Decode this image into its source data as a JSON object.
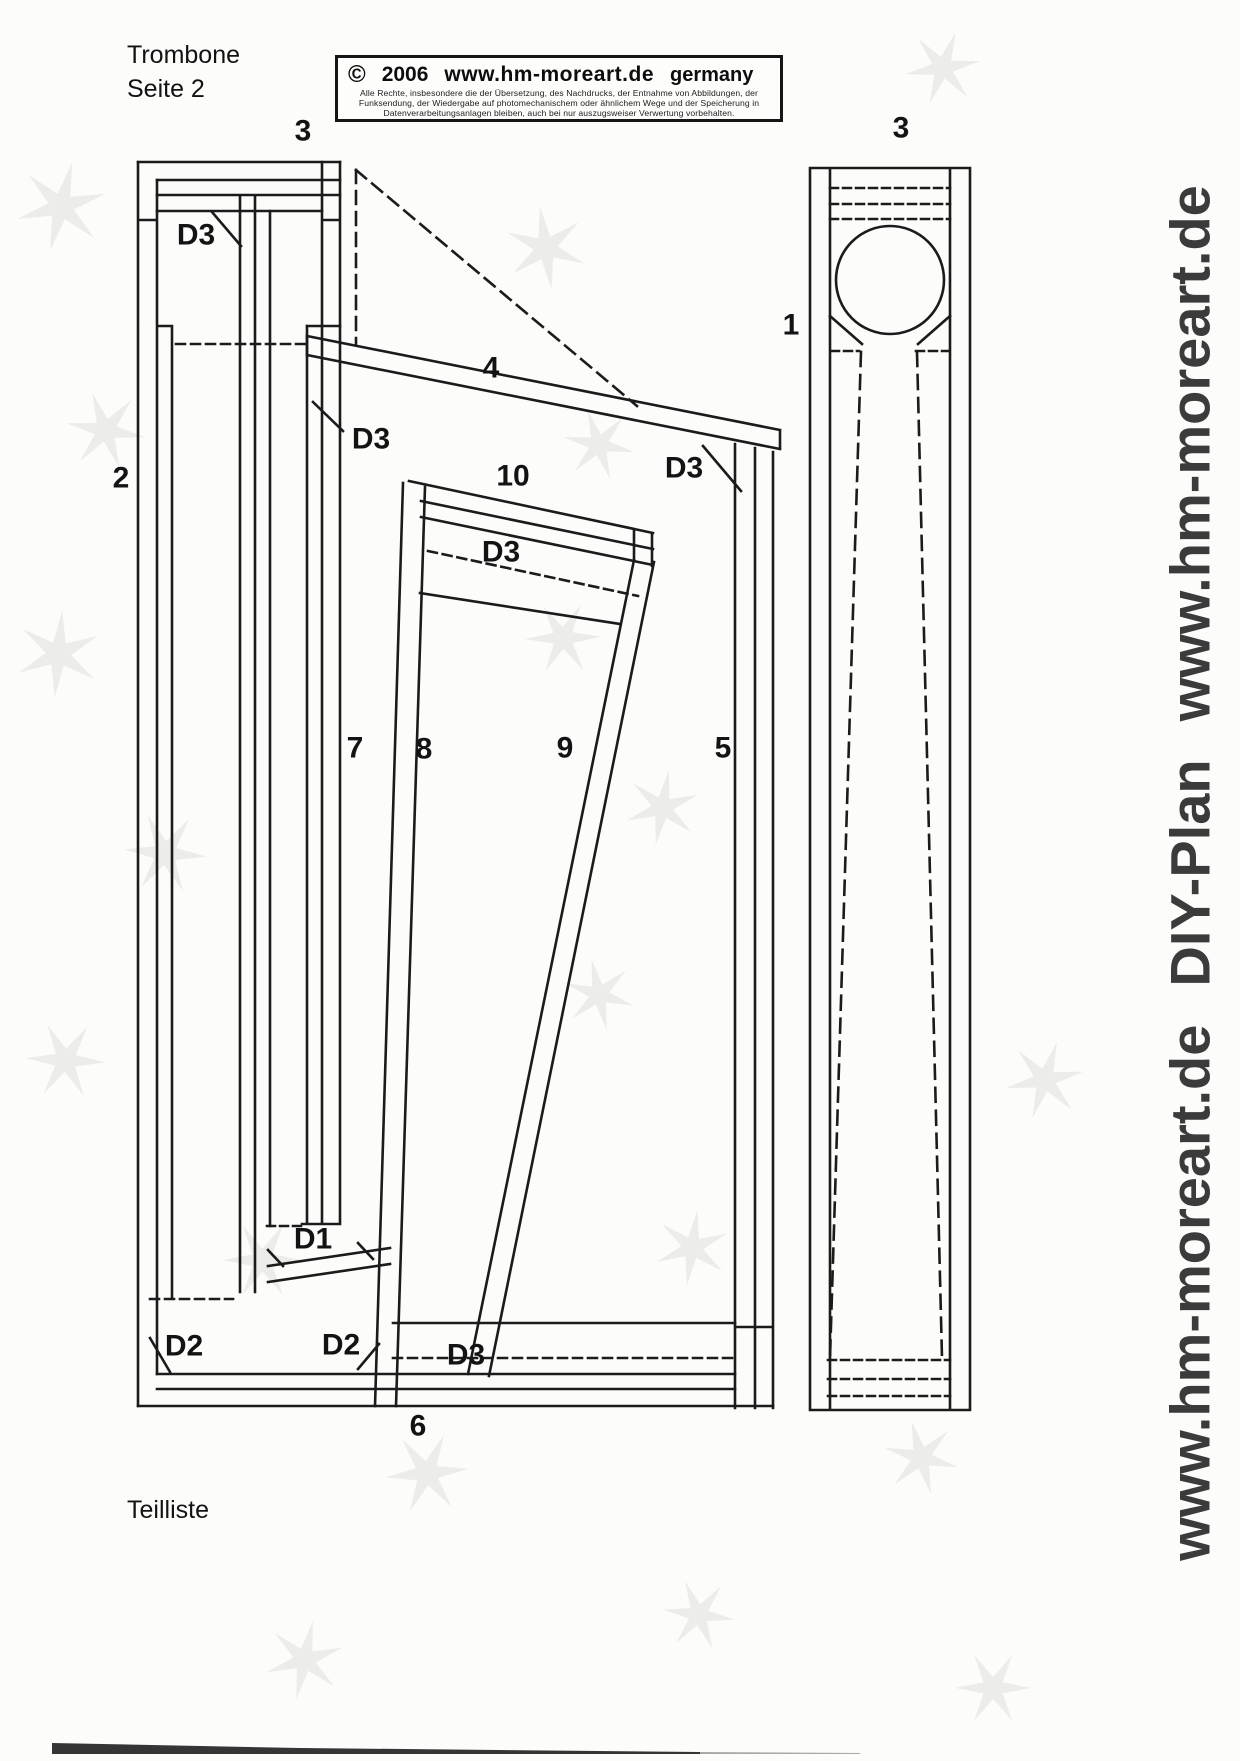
{
  "page": {
    "title_line1": "Trombone",
    "title_line2": "Seite 2",
    "parts_list_label": "Teilliste"
  },
  "copyright_box": {
    "symbol": "©",
    "year": "2006",
    "website": "www.hm-moreart.de",
    "country": "germany",
    "legal_lines": [
      "Alle Rechte, insbesondere die der Übersetzung, des Nachdrucks, der Entnahme von Abbildungen, der",
      "Funksendung, der Wiedergabe auf photomechanischem oder ähnlichem Wege und der Speicherung in",
      "Datenverarbeitungsanlagen bleiben, auch bei nur auszugsweiser Verwertung vorbehalten."
    ]
  },
  "watermark": {
    "segments": [
      "www.hm-moreart.de",
      "DIY-Plan",
      "www.hm-moreart.de"
    ],
    "color": "#3b3b3b"
  },
  "drawing": {
    "line_color": "#1b1b1b",
    "labels": [
      {
        "text": "3",
        "x": 303,
        "y": 133
      },
      {
        "text": "3",
        "x": 901,
        "y": 130
      },
      {
        "text": "1",
        "x": 791,
        "y": 327
      },
      {
        "text": "2",
        "x": 121,
        "y": 480
      },
      {
        "text": "4",
        "x": 491,
        "y": 370
      },
      {
        "text": "D3",
        "x": 196,
        "y": 237
      },
      {
        "text": "D3",
        "x": 371,
        "y": 441
      },
      {
        "text": "D3",
        "x": 684,
        "y": 470
      },
      {
        "text": "10",
        "x": 513,
        "y": 478
      },
      {
        "text": "D3",
        "x": 501,
        "y": 554
      },
      {
        "text": "7",
        "x": 355,
        "y": 750
      },
      {
        "text": "8",
        "x": 424,
        "y": 751
      },
      {
        "text": "9",
        "x": 565,
        "y": 750
      },
      {
        "text": "5",
        "x": 723,
        "y": 750
      },
      {
        "text": "D1",
        "x": 313,
        "y": 1241
      },
      {
        "text": "D2",
        "x": 184,
        "y": 1348
      },
      {
        "text": "D2",
        "x": 341,
        "y": 1347
      },
      {
        "text": "D3",
        "x": 466,
        "y": 1357
      },
      {
        "text": "6",
        "x": 418,
        "y": 1428
      }
    ]
  }
}
